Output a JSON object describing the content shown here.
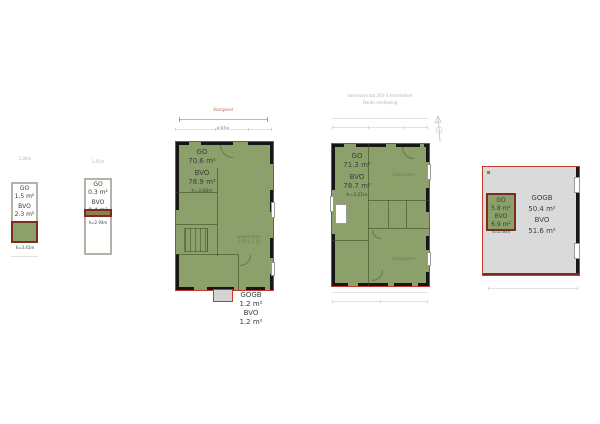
{
  "document": {
    "background": "#ffffff"
  },
  "colors": {
    "outline_red": "#c43a2a",
    "wall_black": "#161616",
    "area_green": "#8ba06a",
    "area_gray": "#dadada",
    "thick_border_red": "#7c2d1d",
    "text_dark": "#3d3d3d",
    "text_faint": "#b5b5b5",
    "dim_red": "#c0685f"
  },
  "plan_attic": {
    "dim_note": "1.06m",
    "go_label": "GO",
    "go_value": "1.5 m²",
    "bvo_label": "BVO",
    "bvo_value": "2.3 m²",
    "height_note": "h=3.41m"
  },
  "plan_shaft": {
    "dim_note": "1.45m",
    "go_label": "GO",
    "go_value": "0.3 m²",
    "bvo_label": "BVO",
    "bvo_value": "0.4 m²",
    "height_note": "h=2.94m"
  },
  "plan_second_floor": {
    "facade_label": "Voorgevel",
    "width_dim": "4.97m",
    "go_label": "GO",
    "go_value": "70.6 m²",
    "bvo_label": "BVO",
    "bvo_value": "78.9 m²",
    "height_note": "h=3.08m",
    "room_label": "woonkamer",
    "room_dims": "4.97 x 7.10",
    "balcony": {
      "gogb_label": "GOGB",
      "gogb_value": "1.2 m²",
      "bvo_label": "BVO",
      "bvo_value": "1.2 m²"
    }
  },
  "plan_third_floor": {
    "header_line1": "Valeriusstraat 203-3 Amsterdam",
    "header_line2": "Derde verdieping",
    "go_label": "GO",
    "go_value": "71.3 m²",
    "bvo_label": "BVO",
    "bvo_value": "78.7 m²",
    "height_note": "h=3.21m",
    "room_label_front": "slaapkamer",
    "room_label_back": "slaapkamer"
  },
  "plan_roof_terrace": {
    "gogb_label": "GOGB",
    "gogb_value": "50.4 m²",
    "bvo_label": "BVO",
    "bvo_value": "51.6 m²",
    "stairhouse": {
      "go_label": "GO",
      "go_value": "5.8 m²",
      "bvo_label": "BVO",
      "bvo_value": "6.9 m²",
      "height_note": "h=2.04m"
    }
  }
}
